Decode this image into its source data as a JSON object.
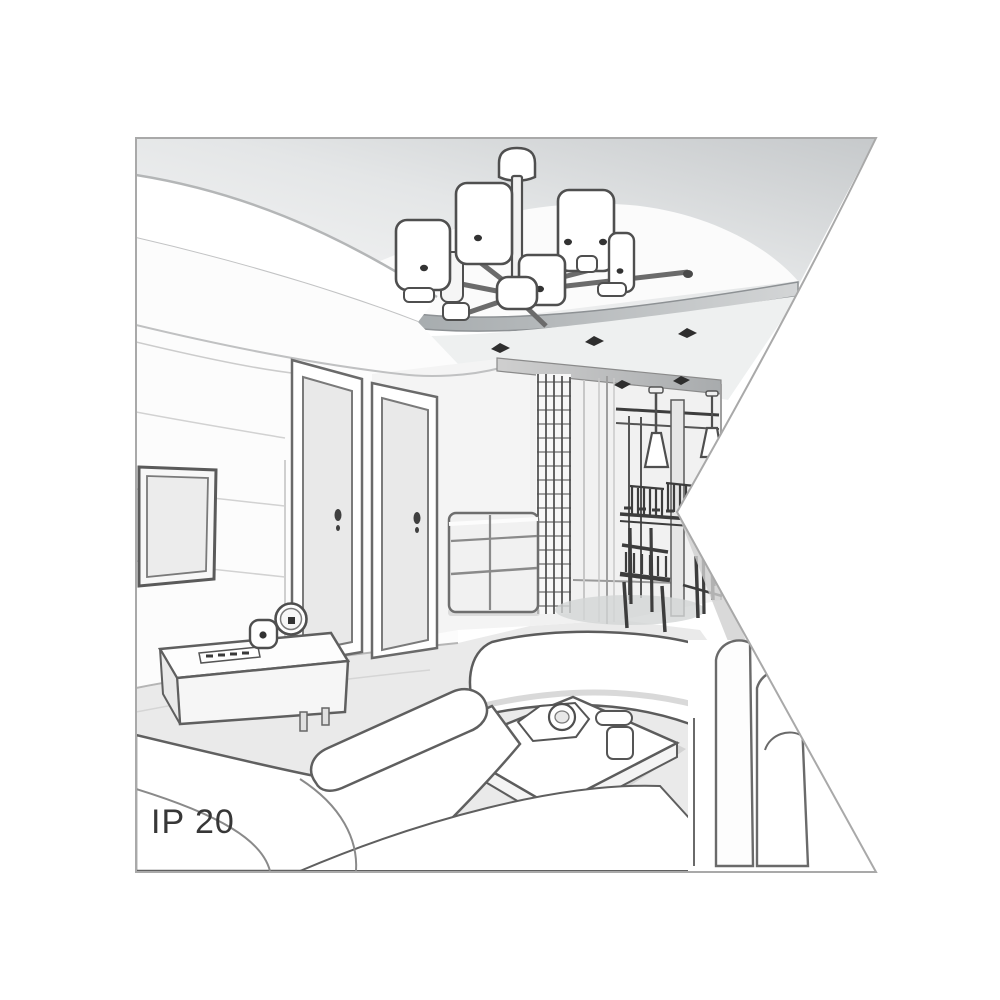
{
  "page": {
    "background": "#ffffff"
  },
  "illustration": {
    "ip_rating_label": "IP 20",
    "style": "grayscale 3D line-art interior rendering",
    "scene": "living room with cove ceiling, suspended ceiling panel, chandelier, hallway dining nook and white sofas",
    "shape": "square panel with a triangular notch cut into its right edge",
    "colors": {
      "background": "#ffffff",
      "border": "#a9a9a9",
      "outline_dark": "#4f4f4f",
      "outline_light": "#b9babb",
      "ceiling_shade": "#c6c9cb",
      "fascia_shade": "#9aa0a3",
      "floor": "#eaeaea",
      "label_text": "#373737"
    },
    "objects": [
      "six-shade ceiling chandelier",
      "suspended ceiling panel",
      "recessed ceiling spotlights",
      "cove ceiling band",
      "wall-mounted tv",
      "tv console with remote, alarm clock and speaker",
      "two interior doors",
      "chest of drawers",
      "open shelving rack",
      "two cone pendant lamps",
      "dining table with chairs",
      "bench sofa",
      "coffee table with cups and tray",
      "corner sofa",
      "right sofa"
    ]
  }
}
